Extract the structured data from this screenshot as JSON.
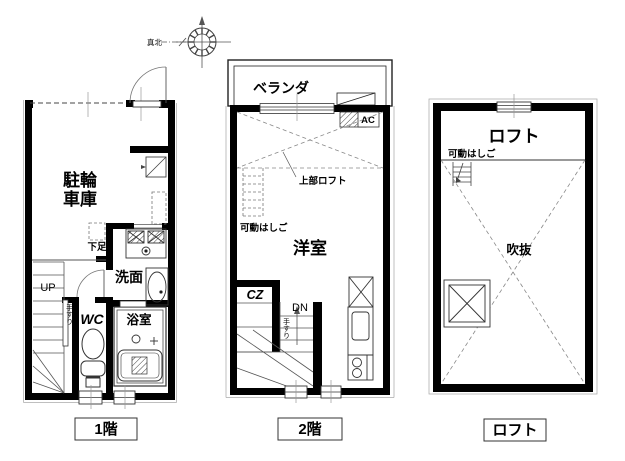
{
  "compass": {
    "north_label": "真北"
  },
  "floor1": {
    "title": "1階",
    "garage_line1": "駐輪",
    "garage_line2": "車庫",
    "shoe_label": "下足",
    "washroom_label": "洗面",
    "wc_label": "WC",
    "bath_label": "浴室",
    "up_label": "UP",
    "handrail_label": "手すり"
  },
  "floor2": {
    "title": "2階",
    "veranda_label": "ベランダ",
    "ac_label": "AC",
    "upper_loft_label": "上部ロフト",
    "ladder_label": "可動はしご",
    "room_label": "洋室",
    "closet_label": "CZ",
    "down_label": "DN",
    "handrail_label": "手すり"
  },
  "loft": {
    "title": "ロフト",
    "loft_label": "ロフト",
    "ladder_label": "可動はしご",
    "void_label": "吹抜"
  }
}
